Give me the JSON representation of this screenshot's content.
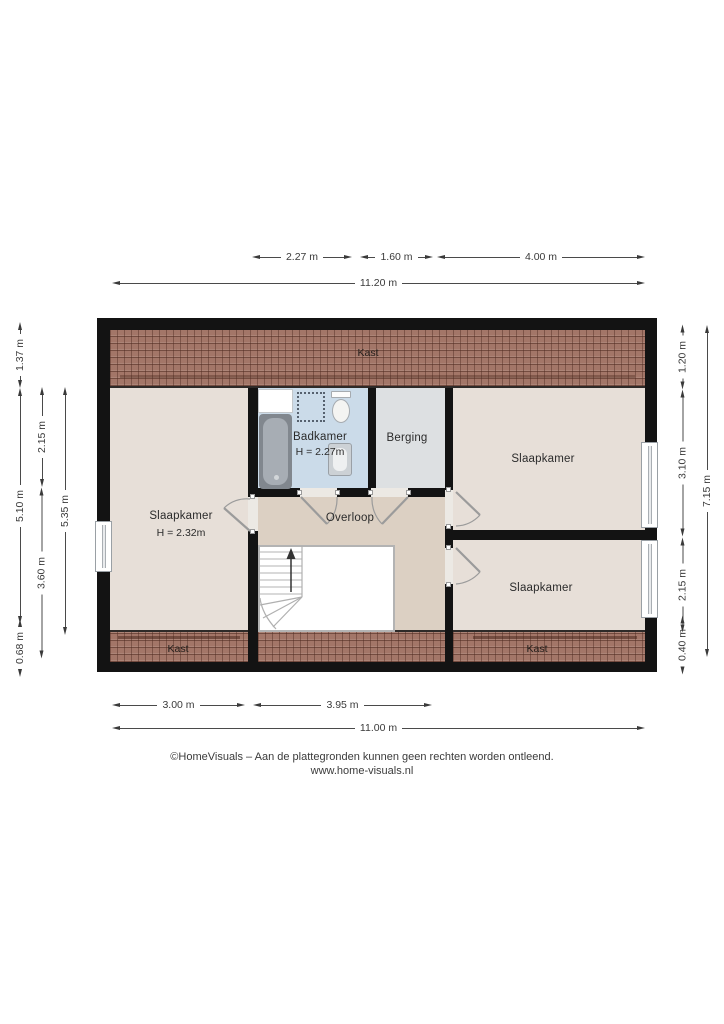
{
  "plan_title": "Floor plan - attic floor (Dutch labels)",
  "rooms": {
    "kast_top": "Kast",
    "kast_bottom_left": "Kast",
    "kast_bottom_right": "Kast",
    "slaapkamer_left": "Slaapkamer",
    "slaapkamer_left_height": "H = 2.32m",
    "badkamer": "Badkamer",
    "badkamer_height": "H = 2.27m",
    "berging": "Berging",
    "overloop": "Overloop",
    "slaapkamer_top_right": "Slaapkamer",
    "slaapkamer_bottom_right": "Slaapkamer"
  },
  "dimensions": {
    "top": {
      "badkamer_width": "2.27 m",
      "berging_width": "1.60 m",
      "slaapkamer_right_width": "4.00 m",
      "total": "11.20 m"
    },
    "bottom": {
      "slaapkamer_left_width": "3.00 m",
      "overloop_width": "3.95 m",
      "total": "11.00 m"
    },
    "left": {
      "roof_top": "1.37 m",
      "main": "5.10 m",
      "roof_bottom": "0.68 m",
      "upper": "2.15 m",
      "lower": "3.60 m",
      "inner_total": "5.35 m"
    },
    "right": {
      "roof_top": "1.20 m",
      "slaapkamer_top": "3.10 m",
      "slaapkamer_bottom": "2.15 m",
      "roof_bottom": "0.40 m",
      "total": "7.15 m"
    }
  },
  "fixtures": {
    "bathtub": "bathtub",
    "toilet": "toilet",
    "sink": "washbasin",
    "shower_area": "shower-area",
    "stairs": "staircase-up",
    "doors": "swing-doors",
    "windows": "windows"
  },
  "colors": {
    "wall": "#131313",
    "roof_tiles": "#a37668",
    "floor_bedroom": "#e7dfd8",
    "floor_landing": "#dcd0c3",
    "floor_bathroom": "#cbdbe9",
    "floor_storage": "#dde0e2"
  },
  "footer": {
    "line1": "©HomeVisuals – Aan de plattegronden kunnen geen rechten worden ontleend.",
    "line2": "www.home-visuals.nl"
  }
}
